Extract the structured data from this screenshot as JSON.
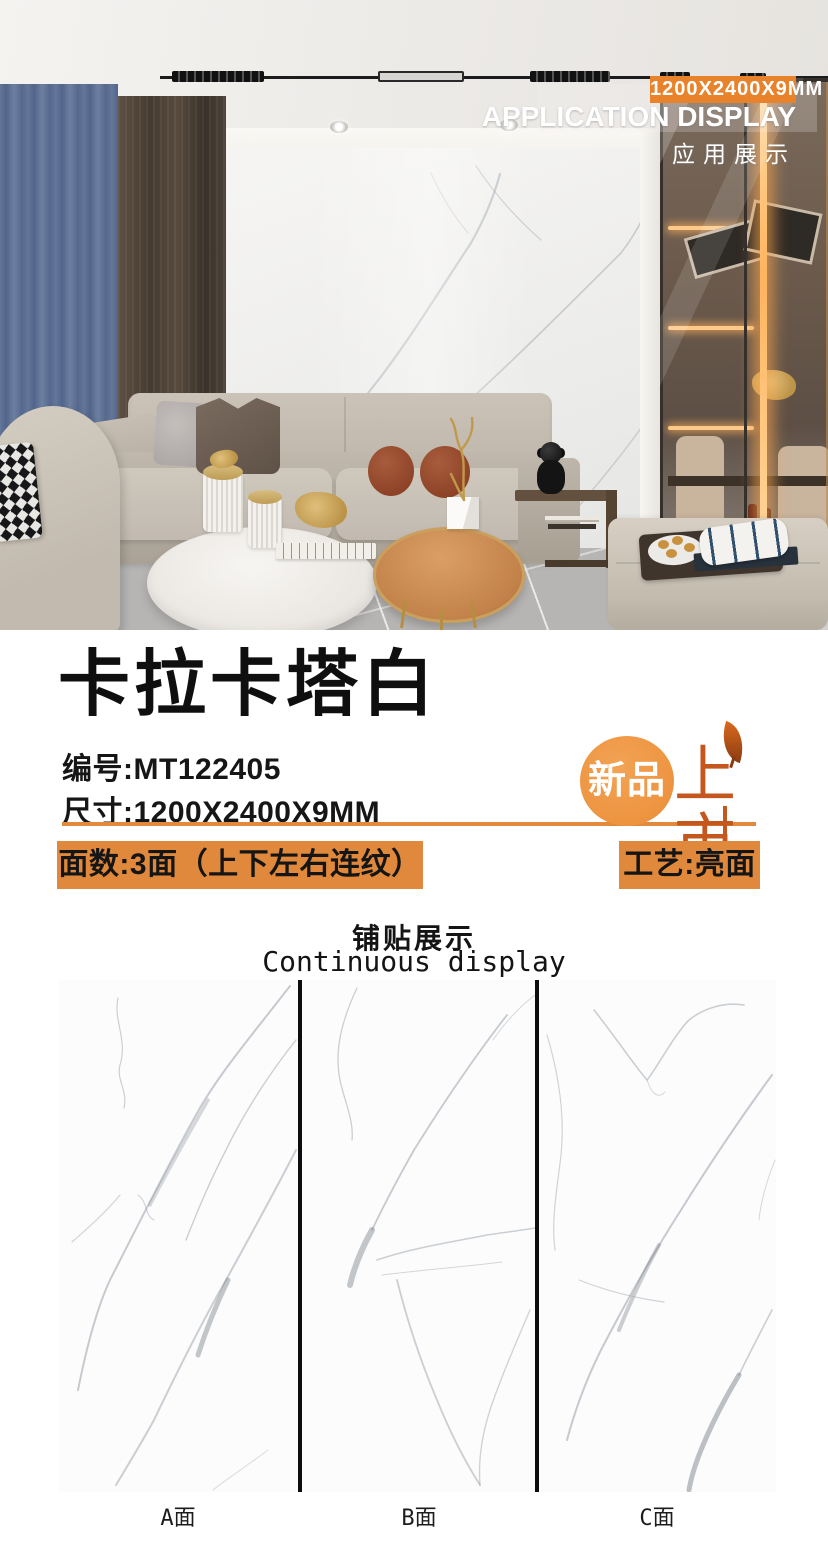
{
  "photo": {
    "size_badge": "1200X2400X9MM",
    "heading_en": "APPLICATION DISPLAY",
    "heading_cn": "应用展示"
  },
  "product": {
    "title": "卡拉卡塔白",
    "code_label": "编号:",
    "code_value": "MT122405",
    "size_label": "尺寸:",
    "size_value": "1200X2400X9MM",
    "new_badge_left": "新品",
    "new_badge_right": "上市",
    "spec_faces": "面数:3面（上下左右连纹）",
    "spec_finish": "工艺:亮面"
  },
  "display": {
    "heading_cn": "铺贴展示",
    "heading_en": "Continuous display",
    "panel_labels": [
      "A面",
      "B面",
      "C面"
    ]
  },
  "colors": {
    "accent_orange": "#E0883B",
    "badge_orange": "#E8832C",
    "new_badge_circle": "#ED9440",
    "new_badge_text": "#C4571E"
  }
}
